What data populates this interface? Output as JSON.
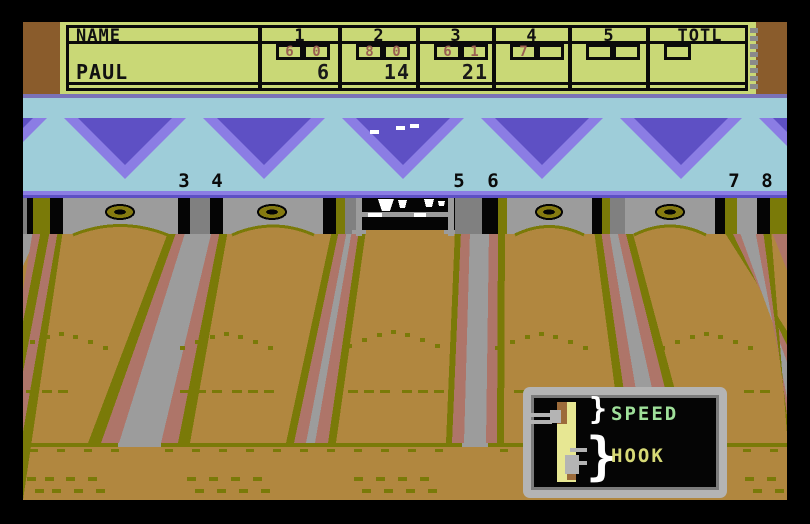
{
  "scorecard": {
    "name_header": "NAME",
    "frame_headers": [
      "1",
      "2",
      "3",
      "4",
      "5"
    ],
    "total_header": "TOTL",
    "player": {
      "name": "PAUL",
      "frames": [
        {
          "roll1": "6",
          "roll2": "0",
          "cum": "6"
        },
        {
          "roll1": "8",
          "roll2": "0",
          "cum": "14"
        },
        {
          "roll1": "6",
          "roll2": "1",
          "cum": "21"
        },
        {
          "roll1": "7",
          "roll2": "",
          "cum": ""
        },
        {
          "roll1": "",
          "roll2": "",
          "cum": ""
        }
      ],
      "total": ""
    }
  },
  "lanes": {
    "numbers": [
      "3",
      "4",
      "5",
      "6",
      "7",
      "8"
    ]
  },
  "meter": {
    "speed_label": "SPEED",
    "hook_label": "HOOK",
    "brace": "}"
  },
  "colors": {
    "scorecard_bg": "#c9d876",
    "roll_text": "#9a5f52",
    "brown_band": "#8a5c2c",
    "blue_band": "#9ecdd9",
    "triangle_light": "#8b7de4",
    "triangle_dark": "#5e50c4",
    "lane_tan": "#b1873f",
    "stripe_olive": "#7a7a08",
    "stripe_salmon": "#ae7569",
    "gutter_gray": "#9c9c9c",
    "speed_text": "#9fe09a",
    "hook_text": "#d6d976"
  }
}
